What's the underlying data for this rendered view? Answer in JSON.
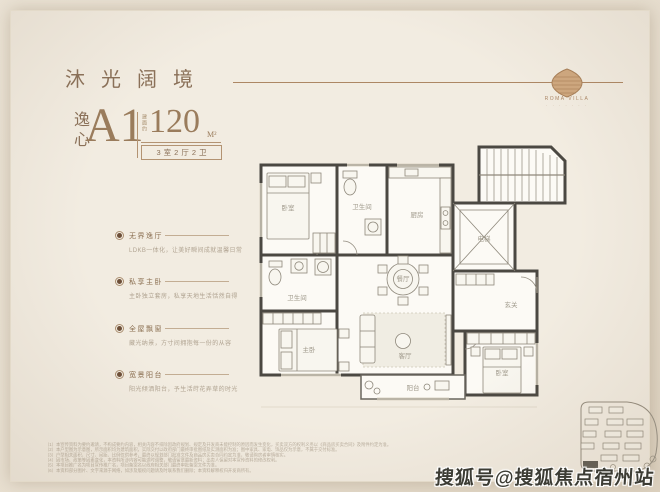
{
  "header": {
    "title": "沐光阔境",
    "logo_text": "ROMA VILLA",
    "logo_sub": "· · · · · · ·"
  },
  "unit": {
    "prefix": "逸心",
    "name": "A1",
    "area_label": "建面约",
    "area_value": "120",
    "area_unit": "M²",
    "spec": "3室2厅2卫"
  },
  "features": [
    {
      "title": "无界逸厅",
      "desc": "LDKB一体化，让美好瞬间成就温馨日常"
    },
    {
      "title": "私享主卧",
      "desc": "主卧独立套房，私享天地生活恬然自得"
    },
    {
      "title": "全屋飘窗",
      "desc": "藏光纳景，方寸间拥抱每一份的从容"
    },
    {
      "title": "宽景阳台",
      "desc": "阳光倾洒阳台，予生活莳花弄草的时光"
    }
  ],
  "floorplan": {
    "rooms": [
      {
        "label": "卧室"
      },
      {
        "label": "卫生间"
      },
      {
        "label": "厨房"
      },
      {
        "label": "电梯"
      },
      {
        "label": "玄关"
      },
      {
        "label": "餐厅"
      },
      {
        "label": "客厅"
      },
      {
        "label": "主卧"
      },
      {
        "label": "卫生间"
      },
      {
        "label": "卧室"
      },
      {
        "label": "阳台"
      }
    ],
    "wall_color": "#4b4842",
    "room_fill": "#fcfaf5"
  },
  "disclaimer": {
    "lines": [
      "（1）本宣传资料为要约邀请，不构成要约内容，相关内容不排除因政府规划、规定及开发商未能控制的原因而发生变化，买卖双方的权利义务以《商品房买卖合同》及附件约定为准。",
      "（2）本户型图为示意图，所示面积均为建筑面积，实际交付以政府部门最终审批图纸及实测面积为准；图中家具、家电、饰品仅为示意，不属于交付标准。",
      "（3）户型相关面积、尺寸、间距、比例仅供参考，最终以规划部门批准文件及商品房买卖合同约定为准，敬请购房者审慎核实。",
      "（4）因市场、政策等因素变化，本资料所涉内容可能适时调整，敬请留意最新资料；出卖人保留对本宣传资料的修改权利。",
      "（5）本项目推广名为项目宣传推广名，项目备案名以政府相关部门最终审批备案文件为准。",
      "（6）本资料部分图片、文字来源于网络，如涉及版权问题请及时联系我们删除；本资料解释权归开发商所有。"
    ]
  },
  "watermark": {
    "text": "搜狐号@搜狐焦点宿州站"
  },
  "palette": {
    "accent_brown": "#8a7058",
    "line_tan": "#ad8764",
    "page_bg": "#f2ece1",
    "outer_bg": "#e7decf",
    "watermark_ink": "#3c3c34"
  }
}
